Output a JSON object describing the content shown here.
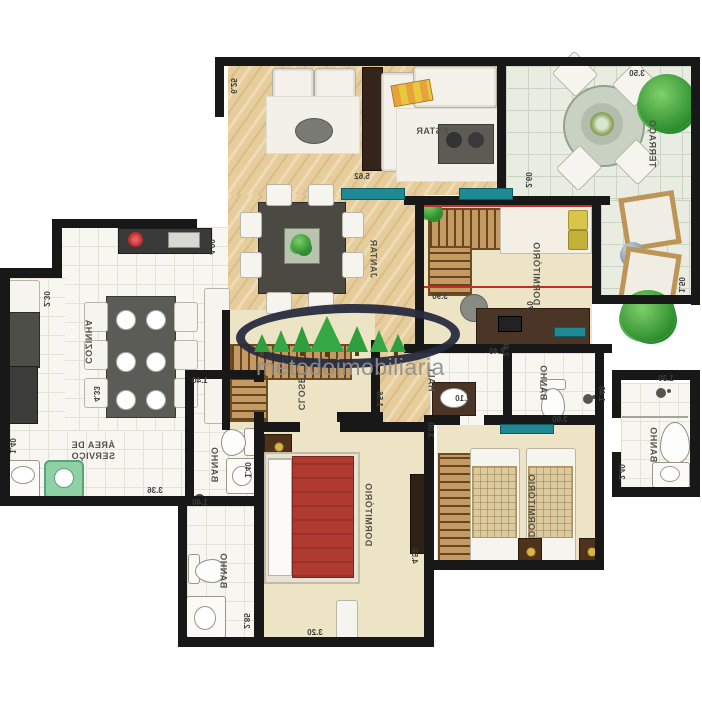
{
  "watermark": {
    "brand": "metodoimobiliaria"
  },
  "rooms": {
    "estar": {
      "label": "ESTAR"
    },
    "jantar": {
      "label": "JANTAR"
    },
    "terraco": {
      "label": "TERRAÇO"
    },
    "cozinha": {
      "label": "COZINHA"
    },
    "area_servico": {
      "label": "ÁREA DE SERVIÇO"
    },
    "closet": {
      "label": "CLOSET"
    },
    "hall": {
      "label": "HALL"
    },
    "dormitorio_suite": {
      "label": "DORMITÓRIO"
    },
    "dormitorio_casal": {
      "label": "DORMITÓRIO"
    },
    "dormitorio_twin": {
      "label": "DORMITÓRIO"
    },
    "banho_servico": {
      "label": "BANHO"
    },
    "banho_social": {
      "label": "BANHO"
    },
    "banho_meio": {
      "label": "BANHO"
    },
    "banho_suite": {
      "label": "BANHO"
    }
  },
  "dimensions": {
    "estar_len": "6.25",
    "estar_w": "5.62",
    "terraco_w": "3.50",
    "terraco_h": "2.60",
    "terraco_side": "1.50",
    "dorm_suite_w": "3.90",
    "dorm_suite_h": "2.70",
    "dorm_suite_desk": "2.40",
    "cozinha_w": "4.00",
    "cozinha_side": "2.30",
    "cozinha_len": "4.33",
    "servico_side": "1.40",
    "servico_w": "3.36",
    "banho_serv_w": "1.40",
    "banho_serv_h": "1.40",
    "banho_soc_w": "1.40",
    "banho_soc_h": "2.85",
    "casal_w": "3.20",
    "casal_h": "4.50",
    "hall_side": "1.56",
    "hall_w": "2.10",
    "twin_h": "3.00",
    "twin_w": "3.60",
    "banho_meio_h": "2.40",
    "banho_meio_w": "1.40",
    "banho_suite_w": "1.30",
    "banho_suite_h": "2.40"
  },
  "colors": {
    "wall": "#181818",
    "wood_floor": "#e7cd9c",
    "bedroom_floor": "#ece4c5",
    "terrace_floor": "#e9ede1",
    "bed_red": "#ae3a30",
    "watermark_navy": "#262b3e",
    "watermark_green": "#2f9e3e",
    "window_teal": "#1f8a94"
  }
}
